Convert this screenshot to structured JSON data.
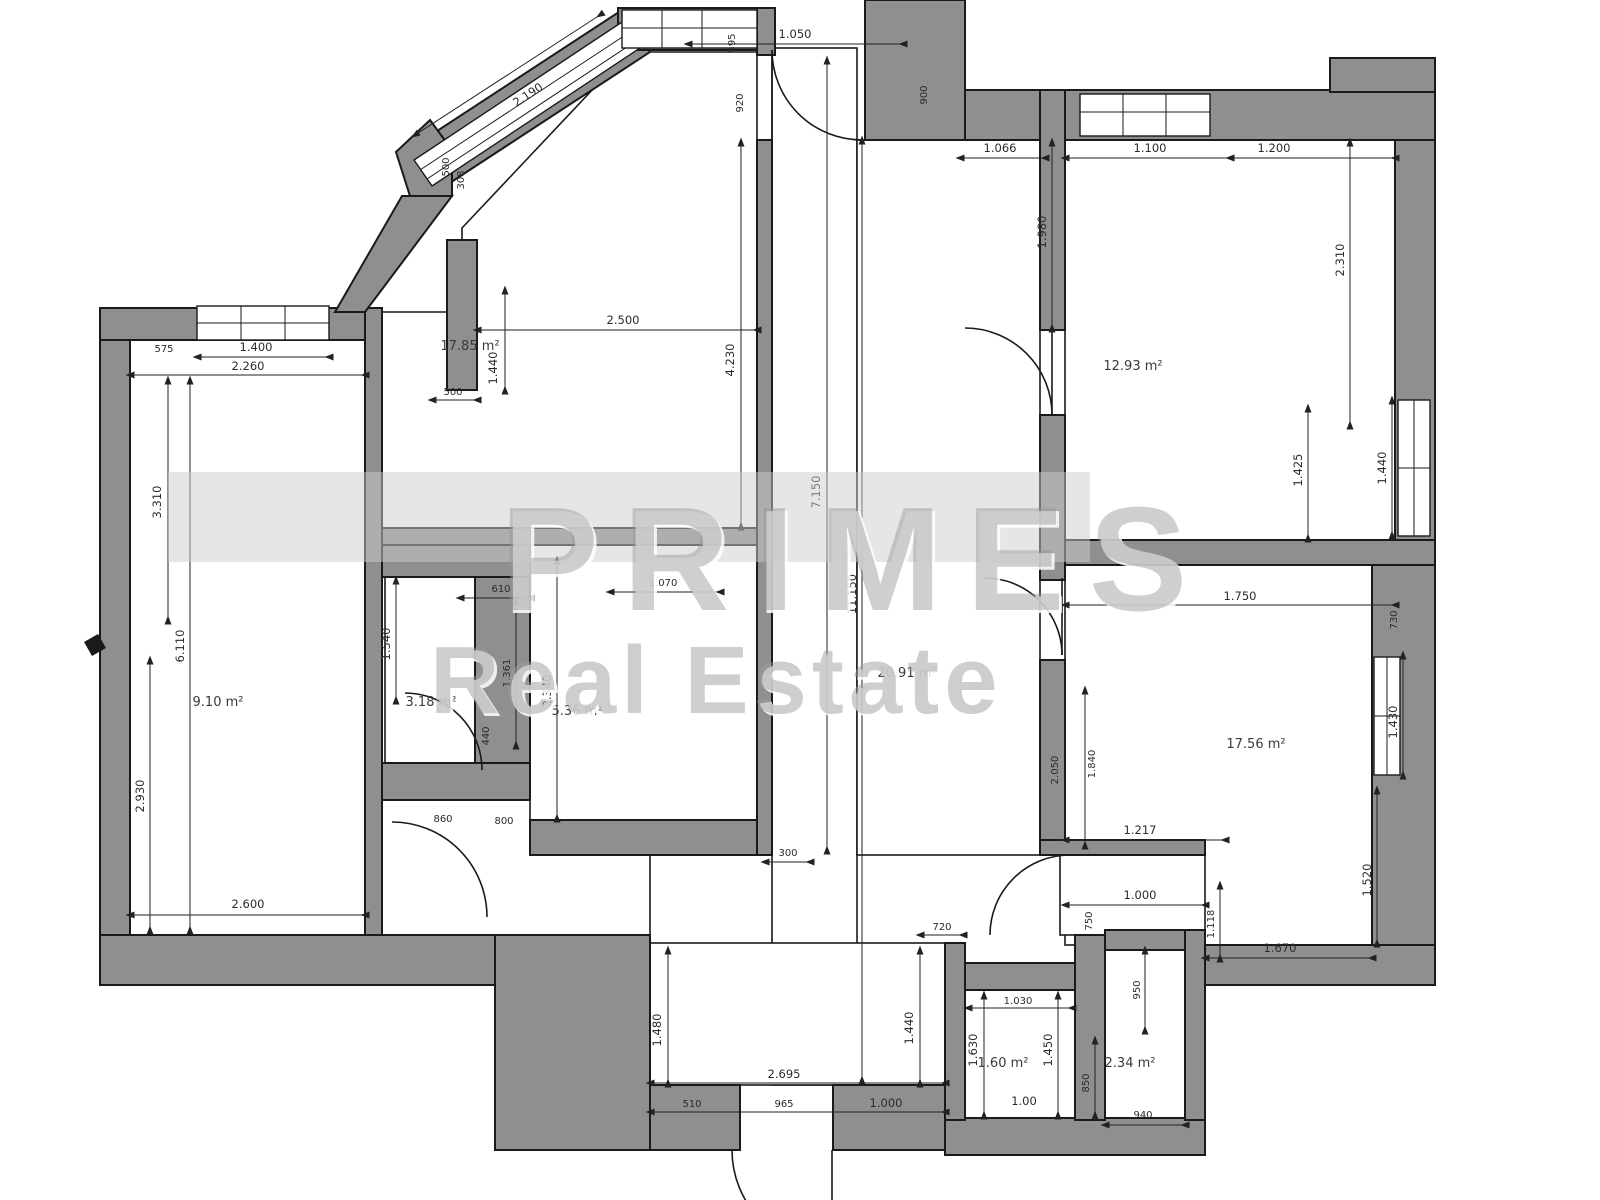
{
  "watermark": {
    "brand": "PRIMES",
    "subtitle": "Real Estate"
  },
  "rooms": [
    {
      "id": "room-top-center",
      "area": "17.85 m²"
    },
    {
      "id": "room-top-right",
      "area": "12.93 m²"
    },
    {
      "id": "room-mid-right",
      "area": "17.56 m²"
    },
    {
      "id": "room-central",
      "area": "20.91 m²"
    },
    {
      "id": "room-left",
      "area": "9.10 m²"
    },
    {
      "id": "bathroom",
      "area": "3.18 m²"
    },
    {
      "id": "kitchen-niche",
      "area": "5.36 m²"
    },
    {
      "id": "wc",
      "area": "1.60 m²"
    },
    {
      "id": "storage",
      "area": "2.34 m²"
    }
  ],
  "dims": [
    "2.190",
    "1.050",
    "595",
    "920",
    "900",
    "500",
    "308",
    "1.066",
    "1.100",
    "1.200",
    "1.980",
    "2.310",
    "1.425",
    "1.440",
    "1.750",
    "730",
    "1.430",
    "1.520",
    "1.670",
    "1.217",
    "1.000",
    "750",
    "2.050",
    "1.840",
    "1.118",
    "950",
    "850",
    "940",
    "1.630",
    "1.450",
    "1.00",
    "1.030",
    "720",
    "2.695",
    "510",
    "965",
    "1.000",
    "1.480",
    "1.440",
    "300",
    "7.150",
    "11.150",
    "2.500",
    "4.230",
    "1.440",
    "500",
    "1.400",
    "2.260",
    "575",
    "3.310",
    "6.110",
    "2.930",
    "2.600",
    "610",
    "1.540",
    "1.361",
    "2.340",
    "1.070",
    "440",
    "860",
    "800"
  ],
  "colors": {
    "wall": "#8f8f8f",
    "line": "#1a1a1a",
    "dim_text": "#2b2b2b",
    "watermark_gray": "#969696",
    "watermark_band": "#d3d3d3"
  }
}
